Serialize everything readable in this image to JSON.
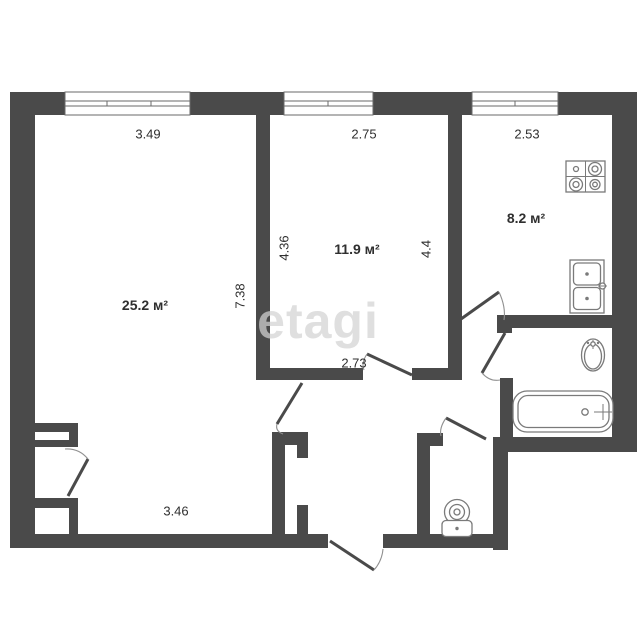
{
  "watermark": "etagi",
  "colors": {
    "wall": "#4a4a4a",
    "fixture_line": "#7a7a7a",
    "label_text": "#2f2f2f",
    "watermark": "#d4d4d4",
    "background": "#ffffff"
  },
  "rooms": [
    {
      "id": "living-room",
      "area_label": "25.2 м²",
      "dim_top": "3.49",
      "dim_bottom": "3.46",
      "dim_right": "7.38"
    },
    {
      "id": "middle-room",
      "area_label": "11.9 м²",
      "dim_top": "2.75",
      "dim_left": "4.36",
      "dim_right": "4.4",
      "dim_bottom": "2.73"
    },
    {
      "id": "kitchen",
      "area_label": "8.2 м²",
      "dim_top": "2.53"
    }
  ],
  "fixtures": [
    "stove-icon",
    "kitchen-sink-icon",
    "washbasin-icon",
    "bathtub-icon",
    "toilet-icon"
  ]
}
